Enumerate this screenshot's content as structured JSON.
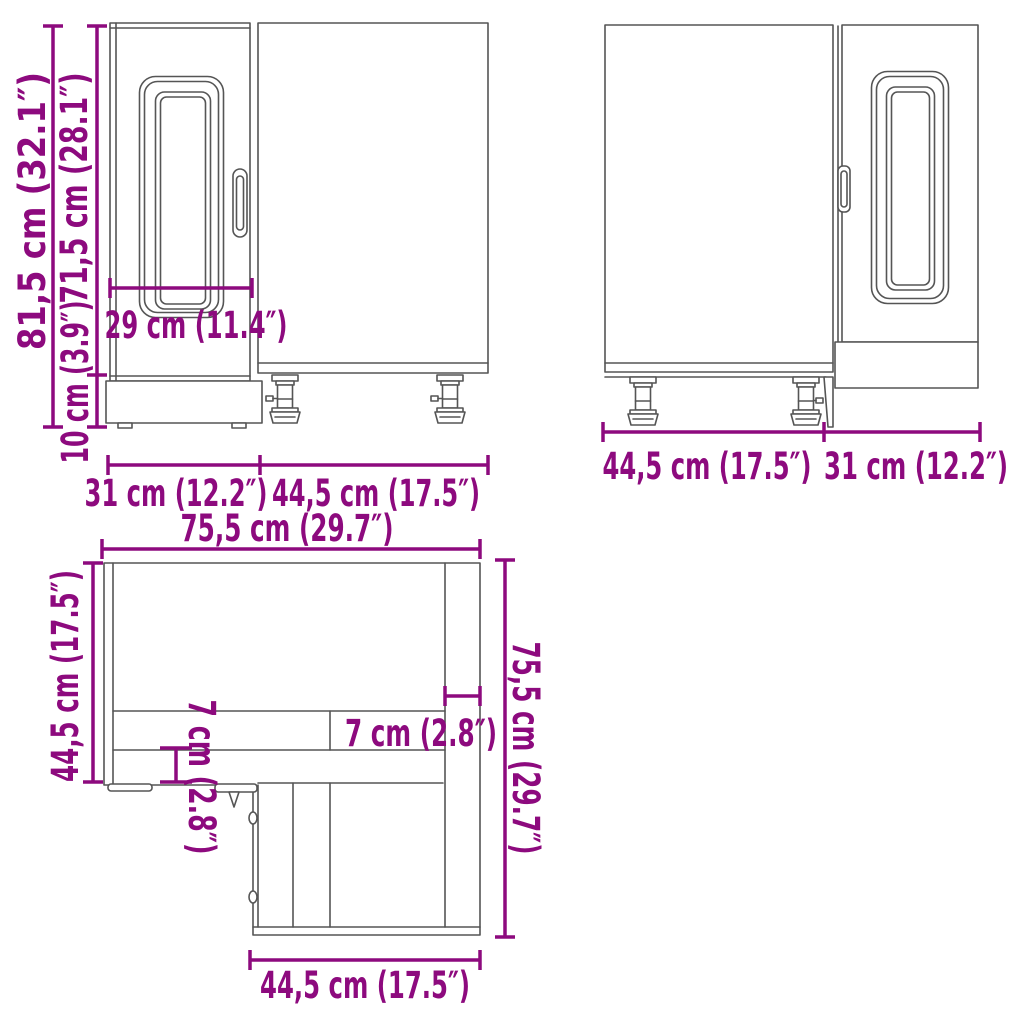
{
  "diagram_title": "corner-base-cabinet-dimension-drawing",
  "colors": {
    "dimension": "#8d0a7e",
    "outline": "#555555",
    "background": "#ffffff"
  },
  "front_view": {
    "overall_height": "81,5 cm (32.1″)",
    "door_height": "71,5 cm (28.1″)",
    "plinth_height": "10 cm (3.9″)",
    "door_inner_width": "29 cm (11.4″)",
    "door_width": "31 cm (12.2″)",
    "side_width": "44,5 cm (17.5″)"
  },
  "back_view": {
    "side_width": "44,5 cm (17.5″)",
    "door_width": "31 cm (12.2″)"
  },
  "top_view": {
    "overall_width": "75,5 cm (29.7″)",
    "left_depth": "44,5 cm (17.5″)",
    "front_rail_depth": "7 cm (2.8″)",
    "side_panel_width": "7 cm (2.8″)",
    "overall_depth": "75,5 cm (29.7″)",
    "front_width": "44,5 cm (17.5″)"
  }
}
